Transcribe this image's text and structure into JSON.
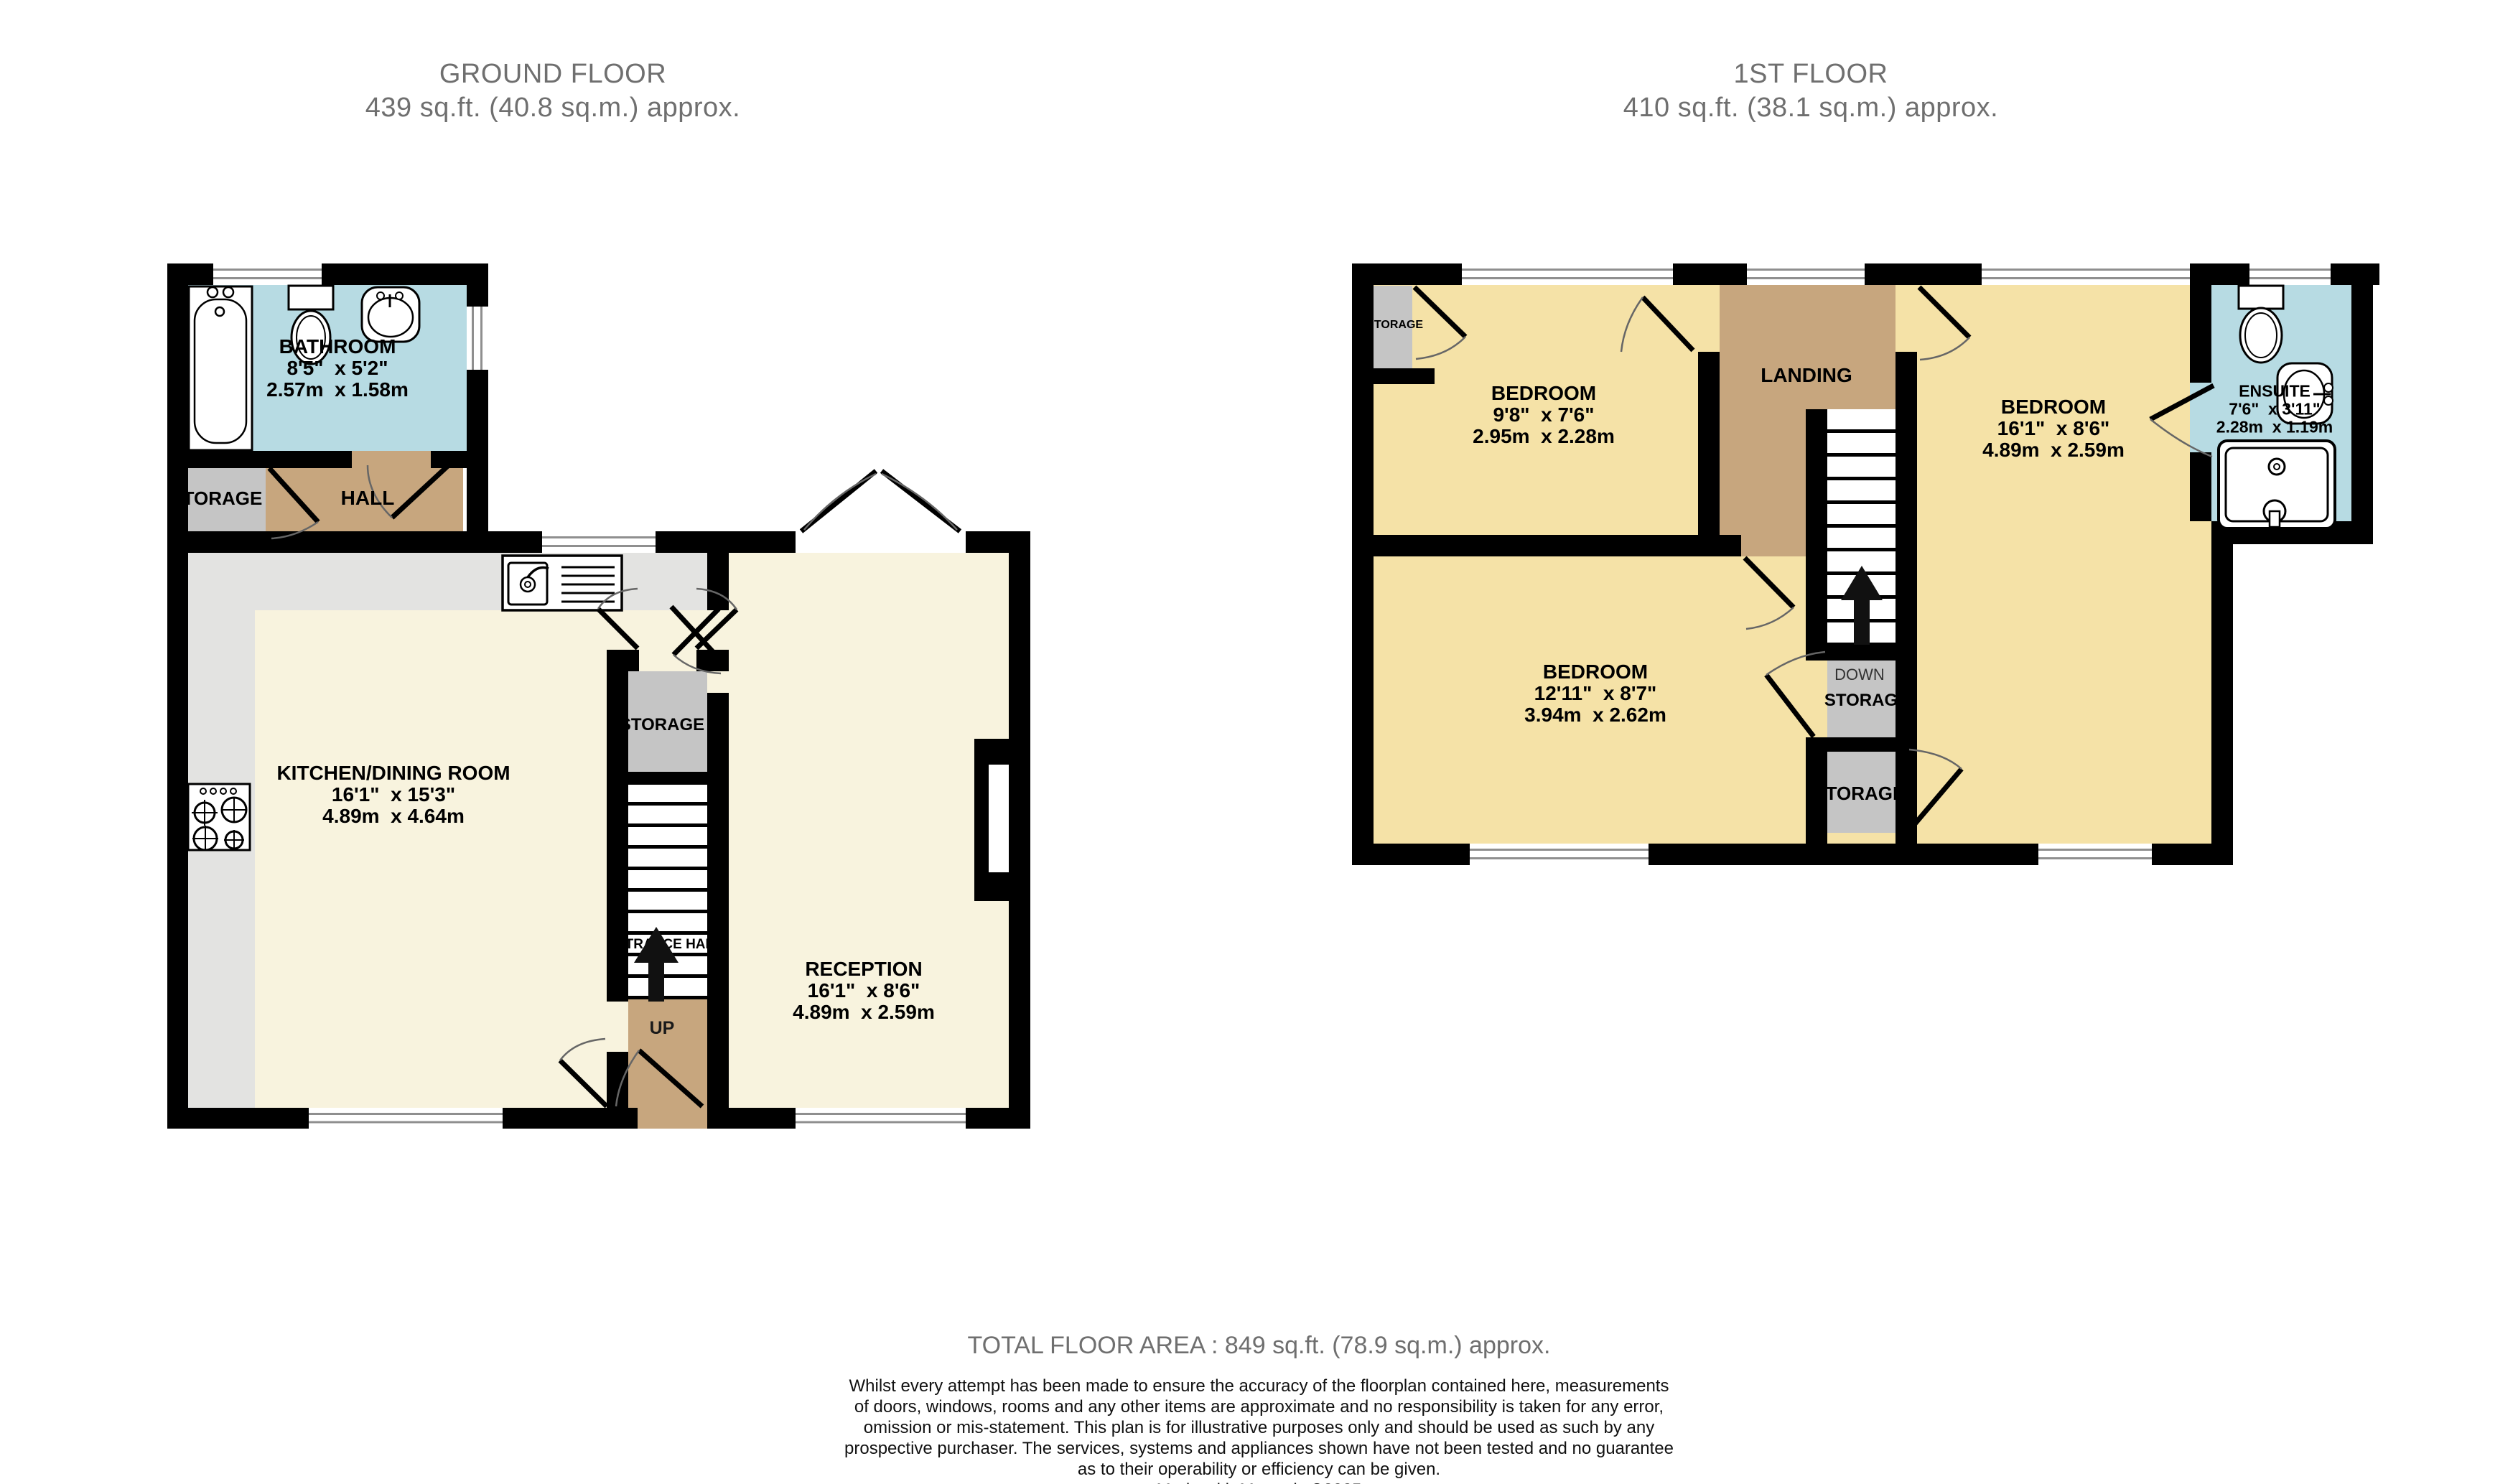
{
  "ground_floor": {
    "title": "GROUND FLOOR",
    "area": "439 sq.ft. (40.8 sq.m.) approx.",
    "rooms": {
      "bathroom": {
        "name": "BATHROOM",
        "imperial": "8'5\"  x 5'2\"",
        "metric": "2.57m  x 1.58m"
      },
      "storage": {
        "name": "TORAGE"
      },
      "hall": {
        "name": "HALL"
      },
      "kitchen": {
        "name": "KITCHEN/DINING ROOM",
        "imperial": "16'1\"  x 15'3\"",
        "metric": "4.89m  x 4.64m"
      },
      "stairs_storage": {
        "name": "STORAGE"
      },
      "entrance_hall": {
        "name": "ENTRANCE HALL"
      },
      "up": {
        "name": "UP"
      },
      "reception": {
        "name": "RECEPTION",
        "imperial": "16'1\"  x 8'6\"",
        "metric": "4.89m  x 2.59m"
      }
    }
  },
  "first_floor": {
    "title": "1ST FLOOR",
    "area": "410 sq.ft. (38.1 sq.m.) approx.",
    "rooms": {
      "storage_top": {
        "name": "TORAGE"
      },
      "bedroom1": {
        "name": "BEDROOM",
        "imperial": "9'8\"  x 7'6\"",
        "metric": "2.95m  x 2.28m"
      },
      "landing": {
        "name": "LANDING"
      },
      "bedroom2": {
        "name": "BEDROOM",
        "imperial": "16'1\"  x 8'6\"",
        "metric": "4.89m  x 2.59m"
      },
      "ensuite": {
        "name": "ENSUITE",
        "imperial": "7'6\"  x 3'11\"",
        "metric": "2.28m  x 1.19m"
      },
      "bedroom3": {
        "name": "BEDROOM",
        "imperial": "12'11\"  x 8'7\"",
        "metric": "3.94m  x 2.62m"
      },
      "down": {
        "name": "DOWN"
      },
      "down_storage": {
        "name": "STORAG"
      },
      "storage_bottom": {
        "name": "TORAGE"
      }
    }
  },
  "footer": {
    "total": "TOTAL FLOOR AREA : 849 sq.ft. (78.9 sq.m.) approx.",
    "disclaimer_lines": [
      "Whilst every attempt has been made to ensure the accuracy of the floorplan contained here, measurements",
      "of doors, windows, rooms and any other items are approximate and no responsibility is taken for any error,",
      "omission or mis-statement. This plan is for illustrative purposes only and should be used as such by any",
      "prospective purchaser. The services, systems and appliances shown have not been tested and no guarantee",
      "as to their operability or efficiency can be given."
    ],
    "credit": "Made with Metropix ©2025"
  },
  "colors": {
    "wall": "#000000",
    "room_cream": "#F8F3DE",
    "room_yellow": "#F5E2A7",
    "zone_tan": "#C7A67E",
    "wet_room_blue": "#B7DBE3",
    "storage_grey": "#C5C5C5",
    "counter_grey": "#E3E3E1",
    "title_grey": "#6F6F6F"
  }
}
